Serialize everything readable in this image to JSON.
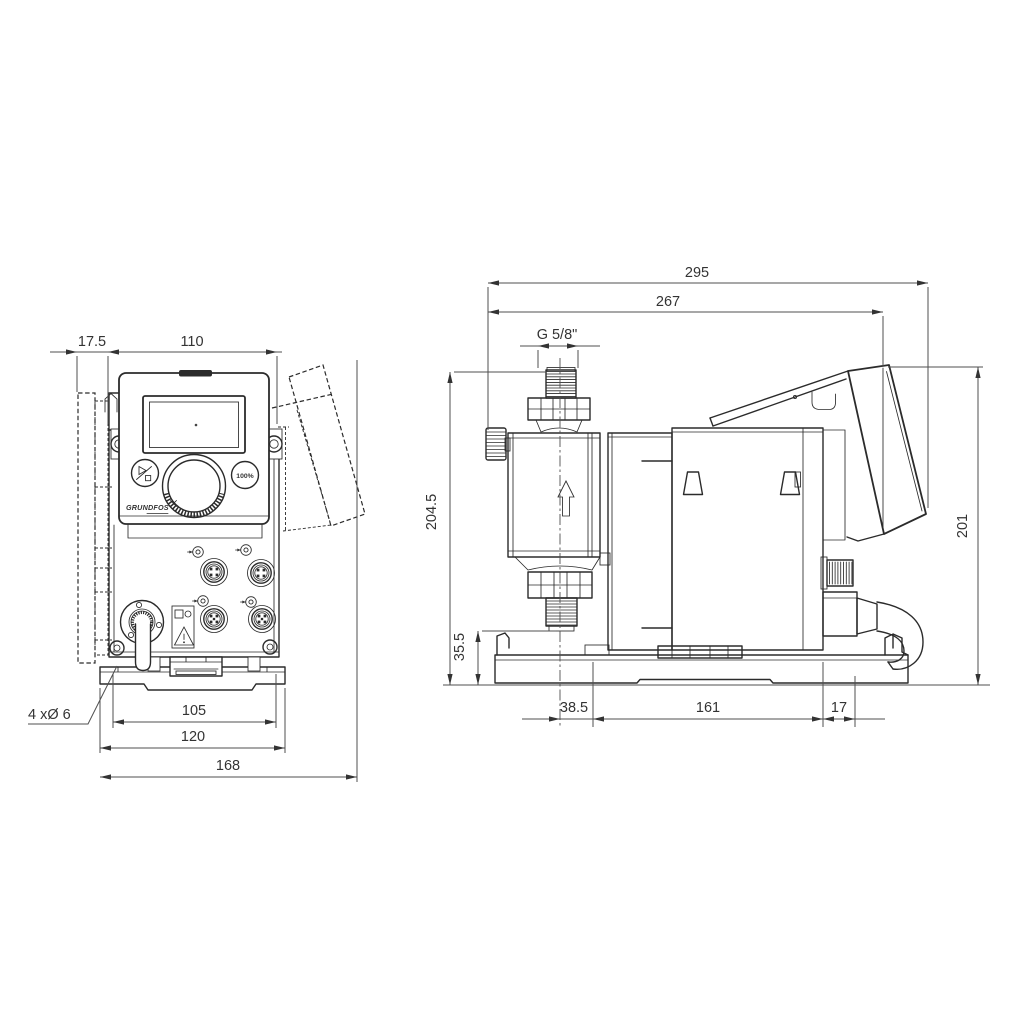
{
  "colors": {
    "background": "#ffffff",
    "line": "#2b2b2b",
    "dimension_line": "#4f4f4f",
    "text": "#333333"
  },
  "front_view": {
    "dimensions": {
      "wall_offset": "17.5",
      "housing_width": "110",
      "hole_spacing": "105",
      "plate_width": "120",
      "overall_width": "168"
    },
    "mounting_holes_label": "4 xØ 6",
    "control_panel": {
      "capacity_button": "100%",
      "logo": "GRUNDFOS"
    }
  },
  "side_view": {
    "dimensions": {
      "overall_length": "295",
      "length_to_plug_top": "267",
      "connection_thread": "G 5/8\"",
      "overall_height": "204.5",
      "valve_clearance_height": "35.5",
      "head_center_to_foot": "38.5",
      "foot_hole_spacing": "161",
      "foot_end_offset": "17",
      "plug_top_height": "201"
    }
  }
}
